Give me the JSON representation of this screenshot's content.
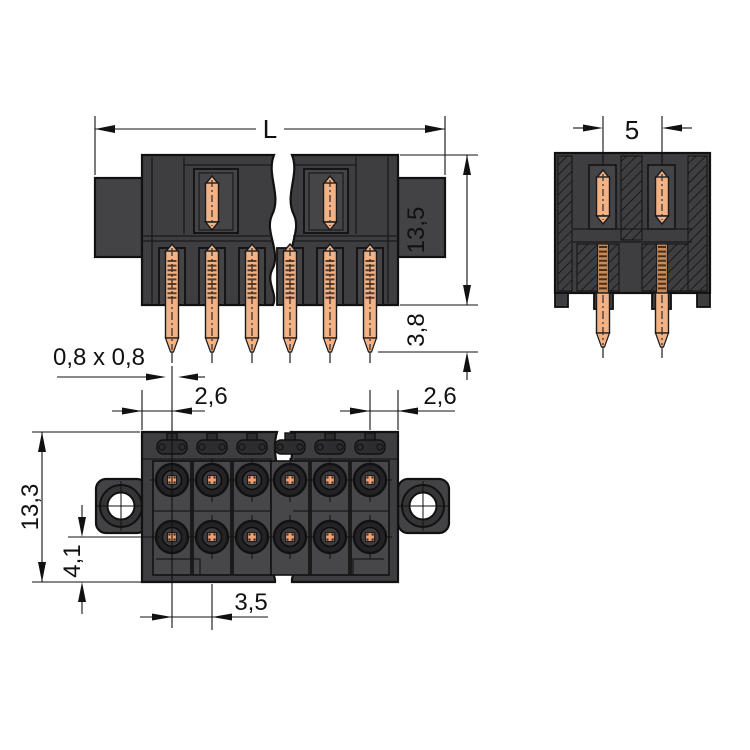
{
  "drawing": {
    "type": "technical-dimension-drawing",
    "subject": "dual-row male pin header connector shown in three views with break lines",
    "dimensions": {
      "overall_length": "L",
      "row_to_row_spacing": "5",
      "housing_height": "13,5",
      "pin_protrusion": "3,8",
      "pin_cross_section": "0,8 x 0,8",
      "left_edge_to_first_pin": "2,6",
      "last_pin_to_right_edge": "2,6",
      "overall_depth": "13,3",
      "pin_row_to_bottom_edge": "4,1",
      "pin_pitch": "3,5"
    },
    "colors": {
      "background": "#ffffff",
      "outline": "#111111",
      "housing_dark": "#3e3e40",
      "housing_panel": "#47474a",
      "pin_copper": "#f3b285",
      "terminal_copper": "#efa071"
    }
  }
}
